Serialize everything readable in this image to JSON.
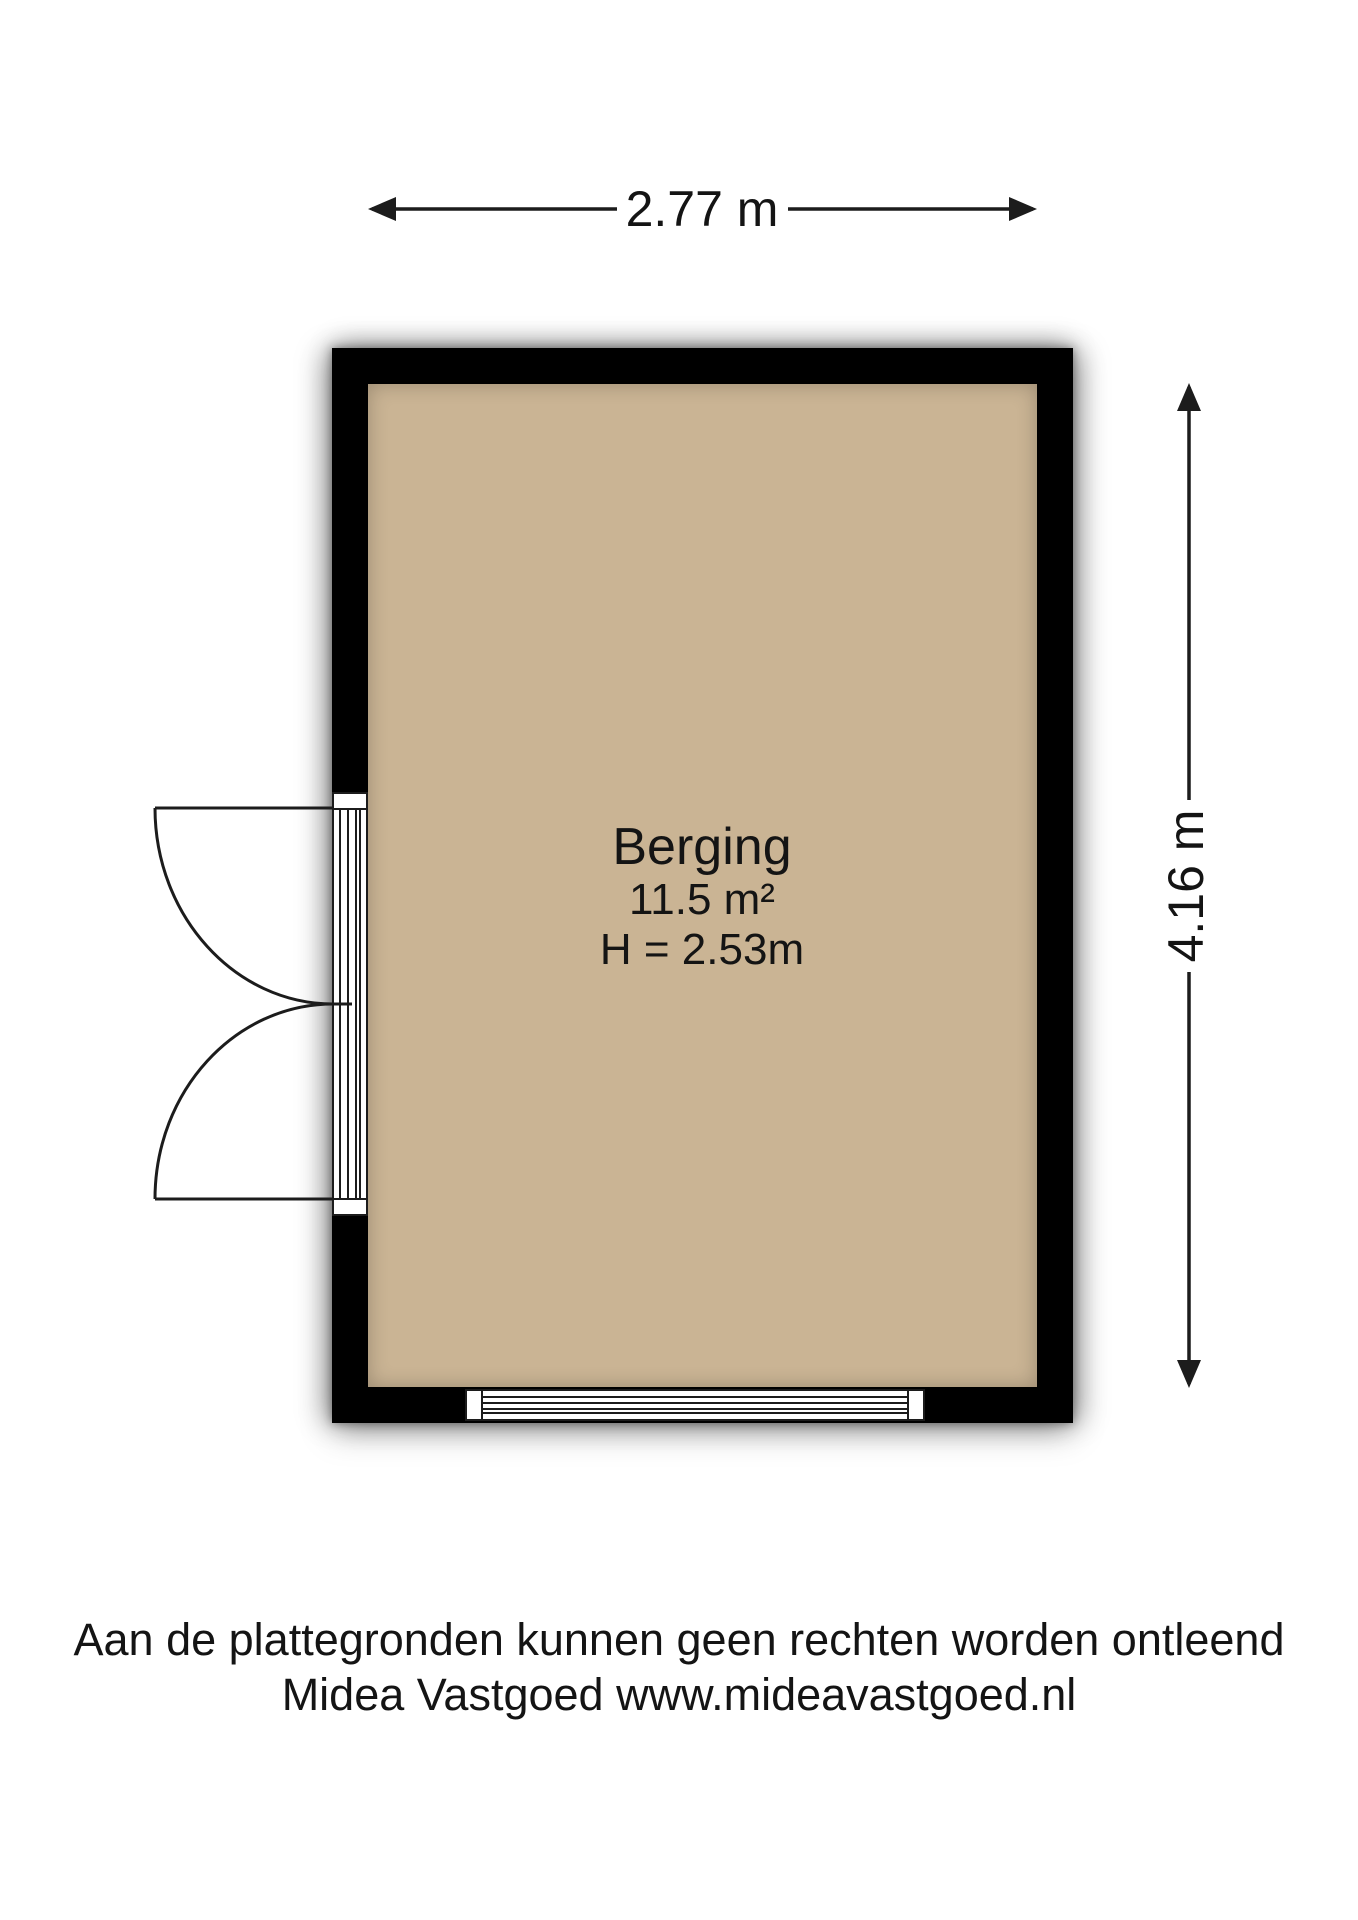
{
  "dimensions": {
    "width_label": "2.77 m",
    "height_label": "4.16 m"
  },
  "room": {
    "name": "Berging",
    "area": "11.5 m²",
    "ceiling_height": "H = 2.53m"
  },
  "footer": {
    "line1": "Aan de plattegronden kunnen geen rechten worden ontleend",
    "line2": "Midea Vastgoed www.mideavastgoed.nl"
  },
  "colors": {
    "background": "#ffffff",
    "floor": "#cab494",
    "wall": "#000000",
    "line": "#1c1c1c"
  }
}
